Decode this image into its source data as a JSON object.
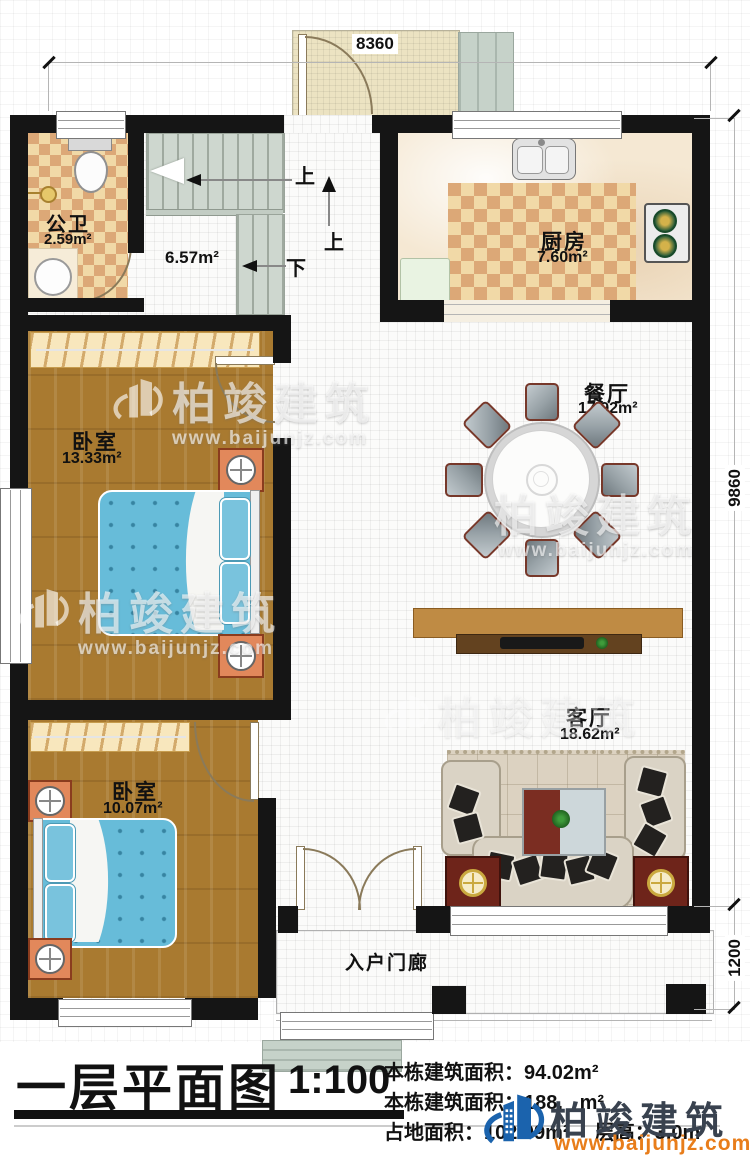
{
  "dims": {
    "top": "8360",
    "right": "9860",
    "porch": "1200"
  },
  "rooms": {
    "bathroom": {
      "name": "公卫",
      "area": "2.59m²"
    },
    "stairhall": {
      "area": "6.57m²"
    },
    "kitchen": {
      "name": "厨房",
      "area": "7.60m²"
    },
    "dining": {
      "name": "餐厅",
      "area": "17.92m²"
    },
    "bedroom1": {
      "name": "卧室",
      "area": "13.33m²"
    },
    "bedroom2": {
      "name": "卧室",
      "area": "10.07m²"
    },
    "living": {
      "name": "客厅",
      "area": "18.62m²"
    },
    "porch": {
      "name": "入户门廊"
    }
  },
  "stairs": {
    "up": "上",
    "up2": "上",
    "down": "下"
  },
  "watermark": {
    "brand": "柏竣建筑",
    "url": "www.baijunjz.com"
  },
  "footer": {
    "title": "一层平面图",
    "scale": "1:100",
    "stats": [
      {
        "label": "本栋建筑面积：",
        "value": "94.02m²"
      },
      {
        "label": "本栋建筑面积：",
        "value": "188.   m²"
      },
      {
        "label": "占地面积：",
        "value": "102.09m²"
      },
      {
        "label": "层高：",
        "value": "3.0m"
      }
    ],
    "brand": {
      "name": "柏竣建筑",
      "url": "www.baijunjz.com"
    }
  }
}
